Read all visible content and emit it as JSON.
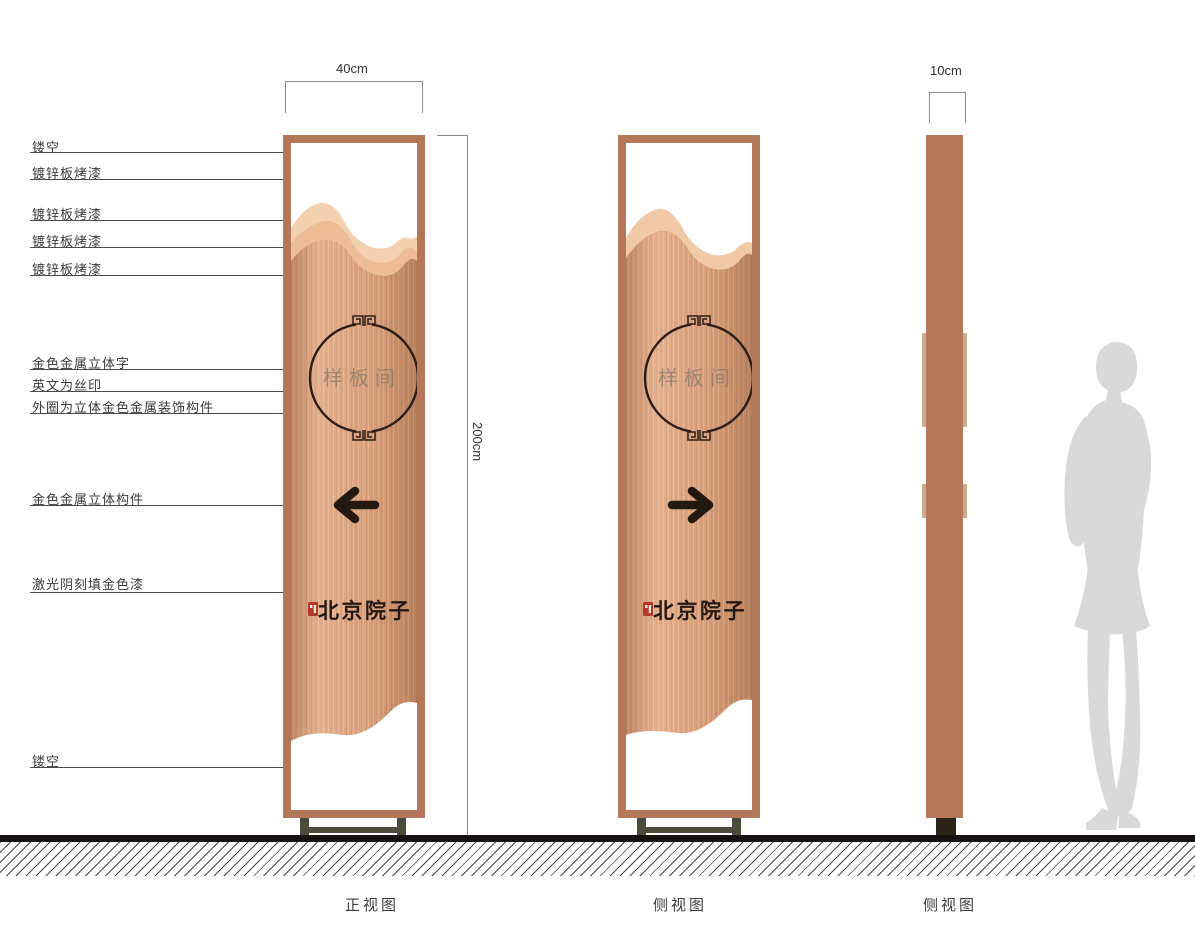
{
  "drawing": {
    "callouts": [
      "镂空",
      "镀锌板烤漆",
      "镀锌板烤漆",
      "镀锌板烤漆",
      "镀锌板烤漆",
      "金色金属立体字",
      "英文为丝印",
      "外圈为立体金色金属装饰构件",
      "金色金属立体构件",
      "激光阴刻填金色漆",
      "镂空"
    ],
    "dimensions": {
      "front_width": "40cm",
      "side_width": "10cm",
      "height": "200cm"
    },
    "sign": {
      "room_label": "样板间",
      "brand": "北京院子"
    },
    "views": [
      {
        "label": "正视图"
      },
      {
        "label": "侧视图"
      },
      {
        "label": "侧视图"
      }
    ],
    "colors": {
      "frame": "#b5775a",
      "panel": "#dca27d",
      "panel_light": "#f3d0ae",
      "panel_mid": "#ecbd97",
      "ink": "#241910",
      "seal_red": "#b23b28",
      "silhouette": "#d9d9d9"
    }
  }
}
